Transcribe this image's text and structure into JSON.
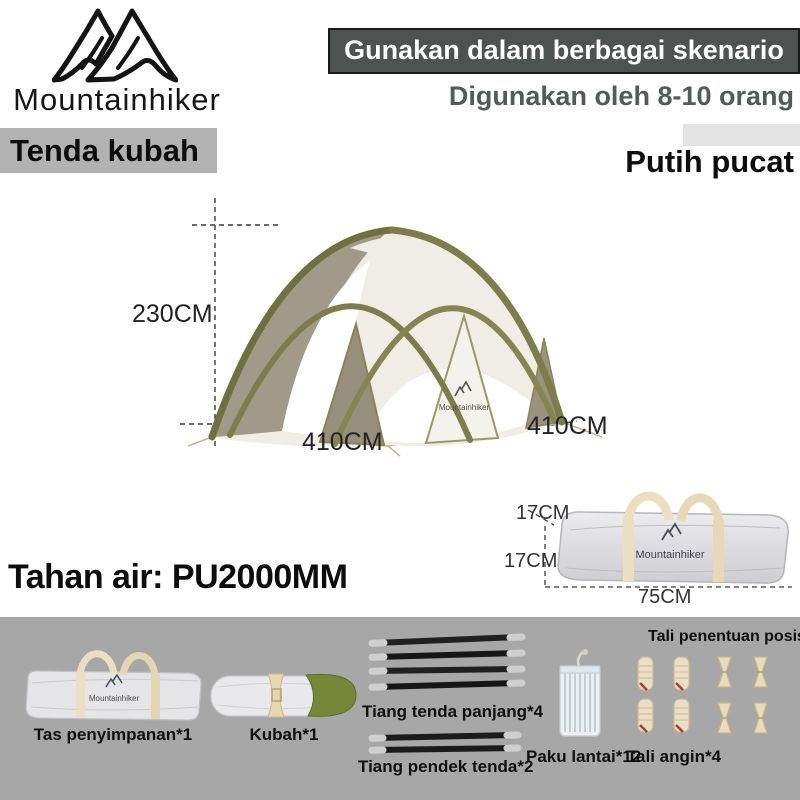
{
  "brand": {
    "name": "Mountainhiker"
  },
  "header": {
    "banner_label": "Gunakan dalam berbagai skenario",
    "capacity_label": "Digunakan oleh 8-10 orang",
    "product_type_label": "Tenda kubah",
    "color_label": "Putih pucat"
  },
  "tent_figure": {
    "height_label": "230CM",
    "front_width_label": "410CM",
    "side_width_label": "410CM",
    "canvas_logo": "Mountainhiker"
  },
  "bag_figure": {
    "depth_label": "17CM",
    "height_label": "17CM",
    "length_label": "75CM",
    "bag_logo": "Mountainhiker"
  },
  "specs": {
    "waterproof_label": "Tahan air: PU2000MM"
  },
  "components": {
    "storage_bag_label": "Tas penyimpanan*1",
    "storage_bag_logo": "Mountainhiker",
    "dome_label": "Kubah*1",
    "long_pole_label": "Tiang tenda panjang*4",
    "short_pole_label": "Tiang pendek tenda*2",
    "stake_label": "Paku lantai*12",
    "wind_rope_label": "Tali angin*4",
    "positioning_rope_label": "Tali penentuan posisi*4"
  },
  "colors": {
    "banner_bg": "#4e5251",
    "banner_text": "#ffffff",
    "capacity_text": "#545a58",
    "product_type_bg": "#b2b2b2",
    "parts_section_bg": "#a7a7a7",
    "frame_olive": "#7c7d4a",
    "panel_taupe": "#9a9181",
    "canvas_white": "#f0ede6"
  }
}
